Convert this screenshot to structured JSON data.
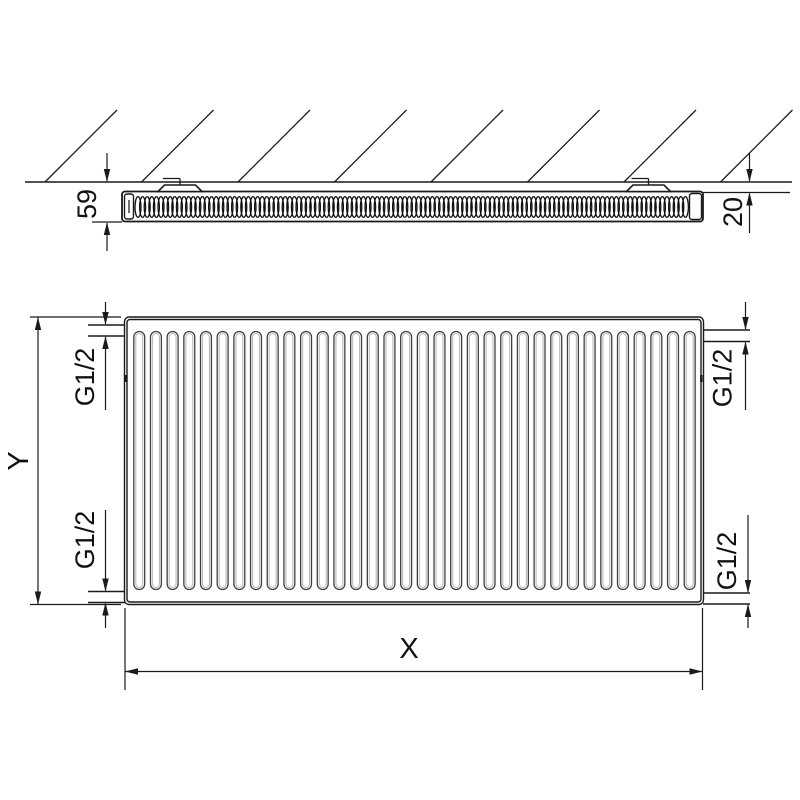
{
  "drawing": {
    "labels": {
      "depth": "59",
      "wall_gap": "20",
      "height": "Y",
      "width": "X",
      "conn_top_left": "G1/2",
      "conn_bottom_left": "G1/2",
      "conn_top_right": "G1/2",
      "conn_bottom_right": "G1/2"
    },
    "colors": {
      "line": "#1a1a1a",
      "fin_outline": "#3f3f3f",
      "fin_inner": "#bcbcbc",
      "coil": "#111111",
      "background": "#ffffff"
    },
    "top_view": {
      "wall_y": 182,
      "hatch": {
        "count": 8,
        "start_x": 45,
        "spacing": 96.5,
        "rise": 72
      },
      "coil": {
        "start_x": 138,
        "end_x": 687,
        "cy": 207,
        "step": 4.6,
        "rx": 3,
        "ry": 10.3
      },
      "brackets": {
        "centers": [
          180,
          648.5
        ],
        "half_base": 22,
        "half_top": 15.5,
        "height": 6.5,
        "tick_top_y": 178.5,
        "tick_len": 17
      }
    },
    "front_view": {
      "fin_count": 34,
      "fin_start_x": 133.8,
      "fin_pitch": 16.68,
      "fin_width": 10.9,
      "fin_top_y": 331.5,
      "fin_bottom_y": 589.5
    }
  }
}
